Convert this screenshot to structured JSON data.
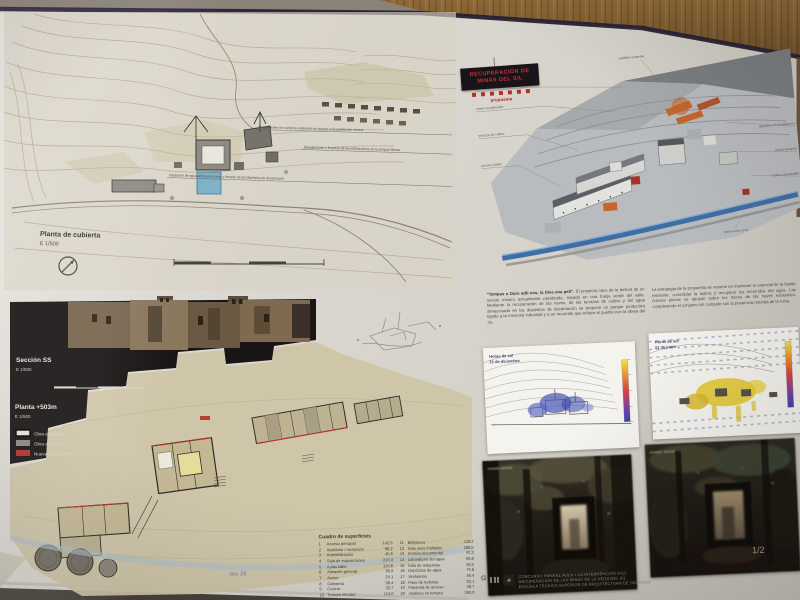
{
  "page_number": "1/2",
  "colors": {
    "board_paper": "#d8d5ce",
    "wood": "#8d6836",
    "accent_red": "#b23226",
    "model_orange": "#c9642a",
    "river_blue": "#4a78a8",
    "shade_blue": "#4a55b5",
    "sun_yellow": "#e2c428",
    "black_panel": "#191514"
  },
  "site_plan": {
    "title": "Planta de cubierta",
    "scale": "E 1/500",
    "annotations": [
      "Se mantienen los caminos existentes de acceso a la explotación minera",
      "Recuperación y limpieza de las edificaciones de la antigua fábrica",
      "Captación de agua arriba para riego y llenado de los depósitos de decantación"
    ]
  },
  "model_3d": {
    "label_top": "castillete existente",
    "labels_left": [
      "cota +520 m",
      "naves recuperadas",
      "terrazas de cultivo",
      "acceso rodado"
    ],
    "labels_right": [
      "depósitos de decantación",
      "nueva pasarela",
      "ladera consolidada"
    ],
    "label_bottom": "paseo junto al río",
    "legend_box": {
      "line1": "RECUPERACIÓN DE",
      "line2": "MINAS DEL SIL",
      "sub": "propuesta"
    }
  },
  "texts": {
    "quote": "“Tempus o Duro adti nos, la Diva ana peti”.",
    "para1": "El proyecto nace de la lectura de un recinto minero actualmente paralizado, situado en una franja verde del valle. Mediante la recuperación de las naves, de las terrazas de cultivo y del agua almacenada en los depósitos de decantación se propone un parque productivo ligado a la memoria industrial y a un recorrido que enlaza el pueblo con la ribera del río.",
    "para2": "La estrategia de la propuesta se resume en mantener lo esencial de la huella existente, consolidar la ladera y recuperar los recorridos del agua. Las nuevas piezas se apoyan sobre los muros de las naves existentes, completando el conjunto sin competir con la presencia rotunda de la ruina."
  },
  "sun_studies": [
    {
      "line1": "Horas de sol",
      "line2": "21 de diciembre"
    },
    {
      "line1": "Horas de sol",
      "line2": "21 de junio"
    }
  ],
  "section_panel": {
    "section_label": "Sección SS",
    "section_scale": "E 1/500",
    "plan_label": "Planta +503m",
    "plan_scale": "E 1/500",
    "legend": [
      {
        "label": "Obra existente",
        "color": "#e8e4da"
      },
      {
        "label": "Obra ampliada",
        "color": "#8a8a86"
      },
      {
        "label": "Nueva intervención",
        "color": "#b23226"
      }
    ],
    "river_label": "Río Sil"
  },
  "program": {
    "title": "Cuadro de superficies",
    "col1": [
      [
        "1",
        "Acceso principal",
        "142,5"
      ],
      [
        "2",
        "Vestíbulo / recepción",
        "86,2"
      ],
      [
        "3",
        "Administración",
        "45,8"
      ],
      [
        "4",
        "Sala de exposiciones",
        "210,3"
      ],
      [
        "5",
        "Aulas taller",
        "124,6"
      ],
      [
        "6",
        "Almacén general",
        "38,9"
      ],
      [
        "7",
        "Aseos",
        "24,1"
      ],
      [
        "8",
        "Cafetería",
        "96,4"
      ],
      [
        "9",
        "Cocina",
        "32,7"
      ],
      [
        "10",
        "Terraza mirador",
        "154,0"
      ]
    ],
    "col2": [
      [
        "11",
        "Biblioteca",
        "118,2"
      ],
      [
        "12",
        "Sala usos múltiples",
        "185,5"
      ],
      [
        "13",
        "Archivo documental",
        "42,3"
      ],
      [
        "14",
        "Laboratorio del agua",
        "66,8"
      ],
      [
        "15",
        "Sala de máquinas",
        "58,2"
      ],
      [
        "16",
        "Depósitos de agua",
        "74,6"
      ],
      [
        "17",
        "Vestuarios",
        "36,4"
      ],
      [
        "18",
        "Paso de turbinas",
        "92,1"
      ],
      [
        "19",
        "Pasarela de acceso",
        "48,7"
      ],
      [
        "20",
        "Jardines en terraza",
        "260,0"
      ]
    ]
  },
  "photos": [
    {
      "caption": "estado actual"
    },
    {
      "caption": "estado actual"
    }
  ],
  "footer": {
    "lines": [
      "CONCURSO PARA EL AULA + LA INTERVENCIÓN 2011",
      "RECUPERACIÓN DE LAS MINAS DE LA VEGA DEL SIL",
      "ESCUELA TÉCNICA SUPERIOR DE ARQUITECTURA DE GRANADA"
    ]
  }
}
